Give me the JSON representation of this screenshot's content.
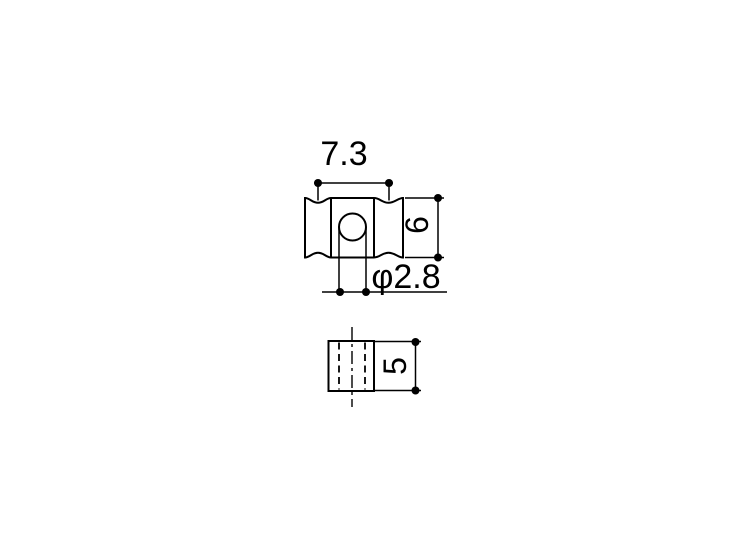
{
  "drawing": {
    "background_color": "#ffffff",
    "line_color": "#000000",
    "front_view": {
      "width_dim_label": "7.3",
      "height_dim_label": "6",
      "hole_dim_label": "φ2.8"
    },
    "side_view": {
      "height_dim_label": "5"
    }
  }
}
